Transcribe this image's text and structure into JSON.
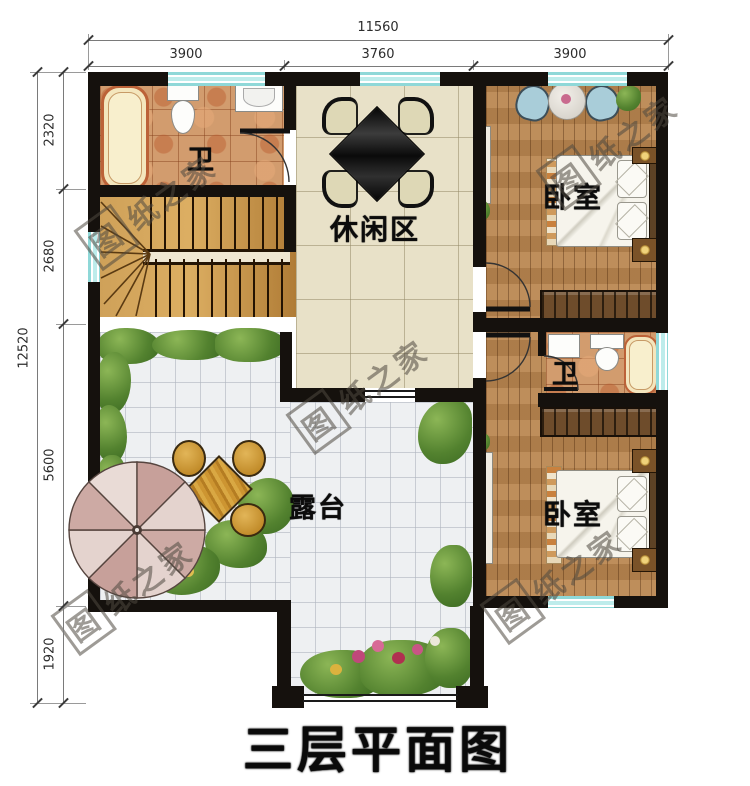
{
  "title": "三层平面图",
  "watermark": {
    "boxed": "图",
    "rest": "纸之家",
    "full": "图纸之家"
  },
  "dimensions": {
    "top": {
      "total": "11560",
      "segments": [
        "3900",
        "3760",
        "3900"
      ]
    },
    "left": {
      "total": "12520",
      "segments": [
        "2320",
        "2680",
        "5600",
        "1920"
      ]
    }
  },
  "rooms": {
    "bathroom_top": "卫",
    "bathroom_mid": "卫",
    "leisure": "休闲区",
    "bedroom_top": "卧室",
    "bedroom_bottom": "卧室",
    "terrace": "露台"
  },
  "colors": {
    "wall": "#15110d",
    "window": "#8fd8d8",
    "wood_floor": "#b9854f",
    "beige_tile": "#e8e1c8",
    "white_tile": "#eef0f2",
    "bath_tile": "#d29c6e",
    "stairs_wood": "#d6a055",
    "greenery": "#53822f",
    "umbrella": "#cfaca6",
    "title_text": "#0a0a0a"
  }
}
